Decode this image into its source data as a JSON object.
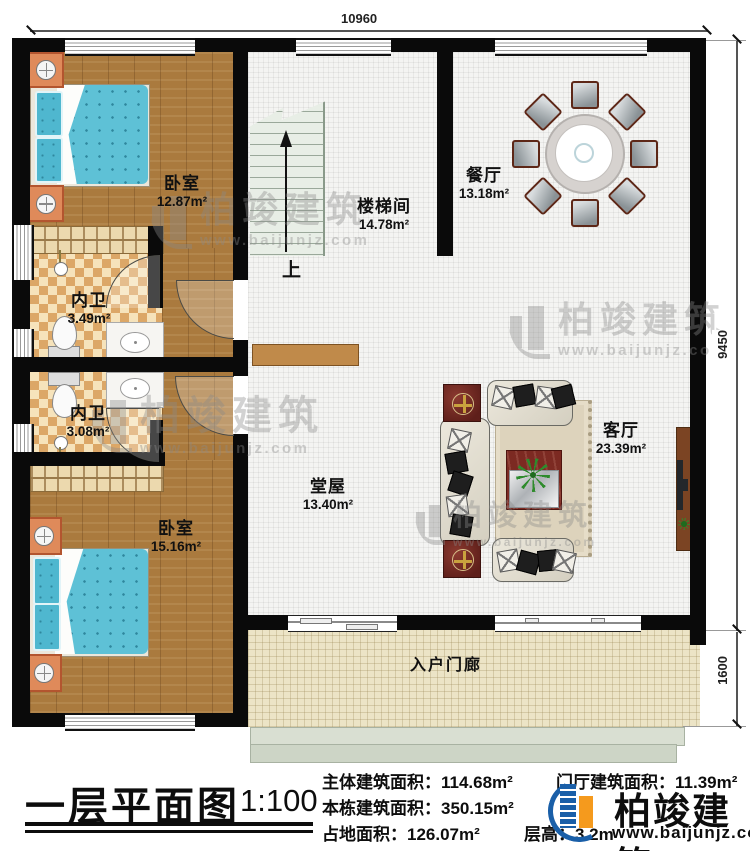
{
  "plan": {
    "dim_top": "10960",
    "dim_right_main": "9450",
    "dim_right_porch": "1600",
    "up_label": "上",
    "rooms": {
      "bedroom1": {
        "name": "卧室",
        "area": "12.87m²"
      },
      "stairwell": {
        "name": "楼梯间",
        "area": "14.78m²"
      },
      "dining": {
        "name": "餐厅",
        "area": "13.18m²"
      },
      "bath1": {
        "name": "内卫",
        "area": "3.49m²"
      },
      "bath2": {
        "name": "内卫",
        "area": "3.08m²"
      },
      "bedroom2": {
        "name": "卧室",
        "area": "15.16m²"
      },
      "hall": {
        "name": "堂屋",
        "area": "13.40m²"
      },
      "living": {
        "name": "客厅",
        "area": "23.39m²"
      },
      "porch": {
        "name": "入户门廊"
      }
    }
  },
  "watermark": {
    "brand": "柏竣建筑",
    "url": "www.baijunjz.com"
  },
  "footer": {
    "title": "一层平面图",
    "scale": "1:100",
    "stats_left": [
      {
        "label": "主体建筑面积：",
        "value": "114.68m²"
      },
      {
        "label": "本栋建筑面积：",
        "value": "350.15m²"
      },
      {
        "label": "占地面积：",
        "value": "126.07m²"
      }
    ],
    "stats_right": [
      {
        "label": "门厅建筑面积：",
        "value": "11.39m²"
      },
      {
        "label": "层高：",
        "value": "3.2m"
      }
    ],
    "brand": {
      "name": "柏竣建筑",
      "url": "www.baijunjz.com"
    }
  },
  "colors": {
    "wall": "#0a0a0a",
    "brand_blue": "#1a5fa8",
    "brand_orange": "#f59a1d",
    "wood": "#aa7a3e",
    "bed_teal": "#5ec1d6",
    "maroon": "#6f2721"
  }
}
